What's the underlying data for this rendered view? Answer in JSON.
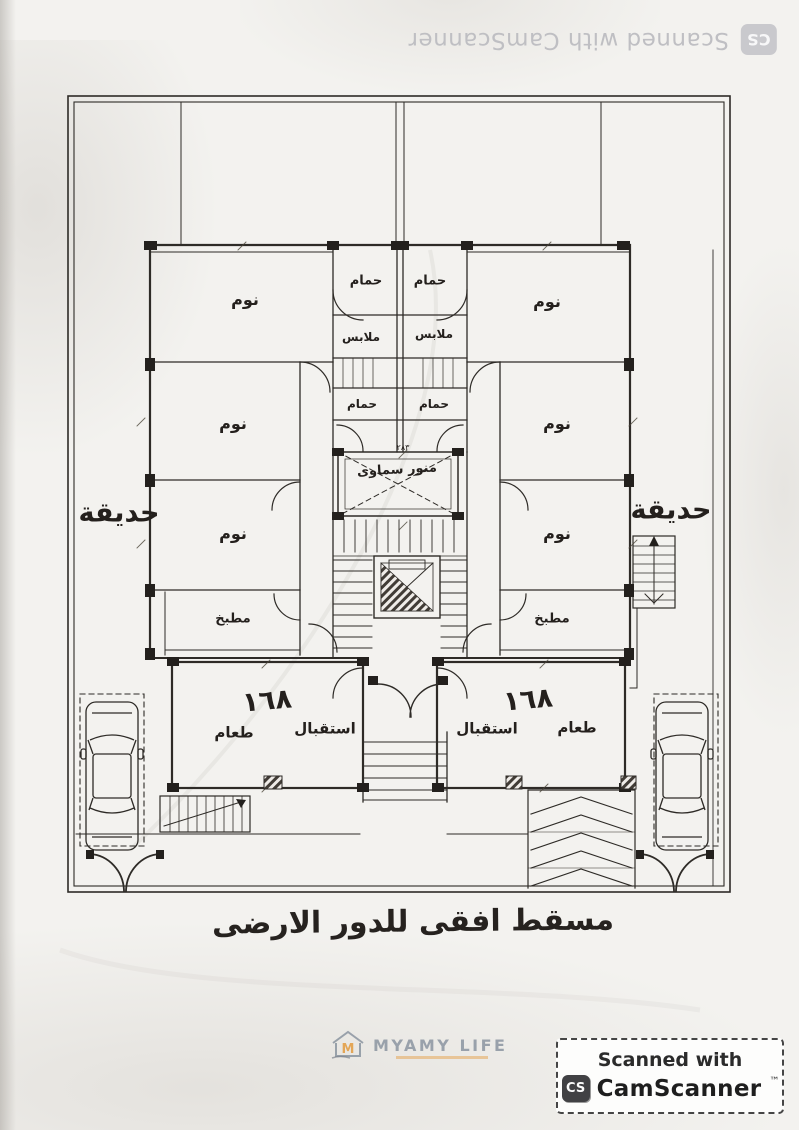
{
  "scan": {
    "top_watermark": {
      "icon_label": "CS",
      "text": "Scanned with CamScanner"
    },
    "bottom_badge": {
      "line1": "Scanned with",
      "icon_label": "CS",
      "brand": "CamScanner",
      "trademark": "™"
    }
  },
  "branding": {
    "logo_text": "MYAMY LIFE"
  },
  "plan": {
    "title": "مسقط افقى للدور الارضى",
    "unit_number": "١٦٨",
    "labels": {
      "bedroom": "نوم",
      "bathroom": "حمام",
      "dressing_room": "ملابس",
      "kitchen": "مطبخ",
      "garden": "حديقة",
      "dining_room": "طعام",
      "reception": "استقبال",
      "skylight": "منور سماوى"
    },
    "dimensions": {
      "skylight_width": "٢٨٣"
    }
  }
}
